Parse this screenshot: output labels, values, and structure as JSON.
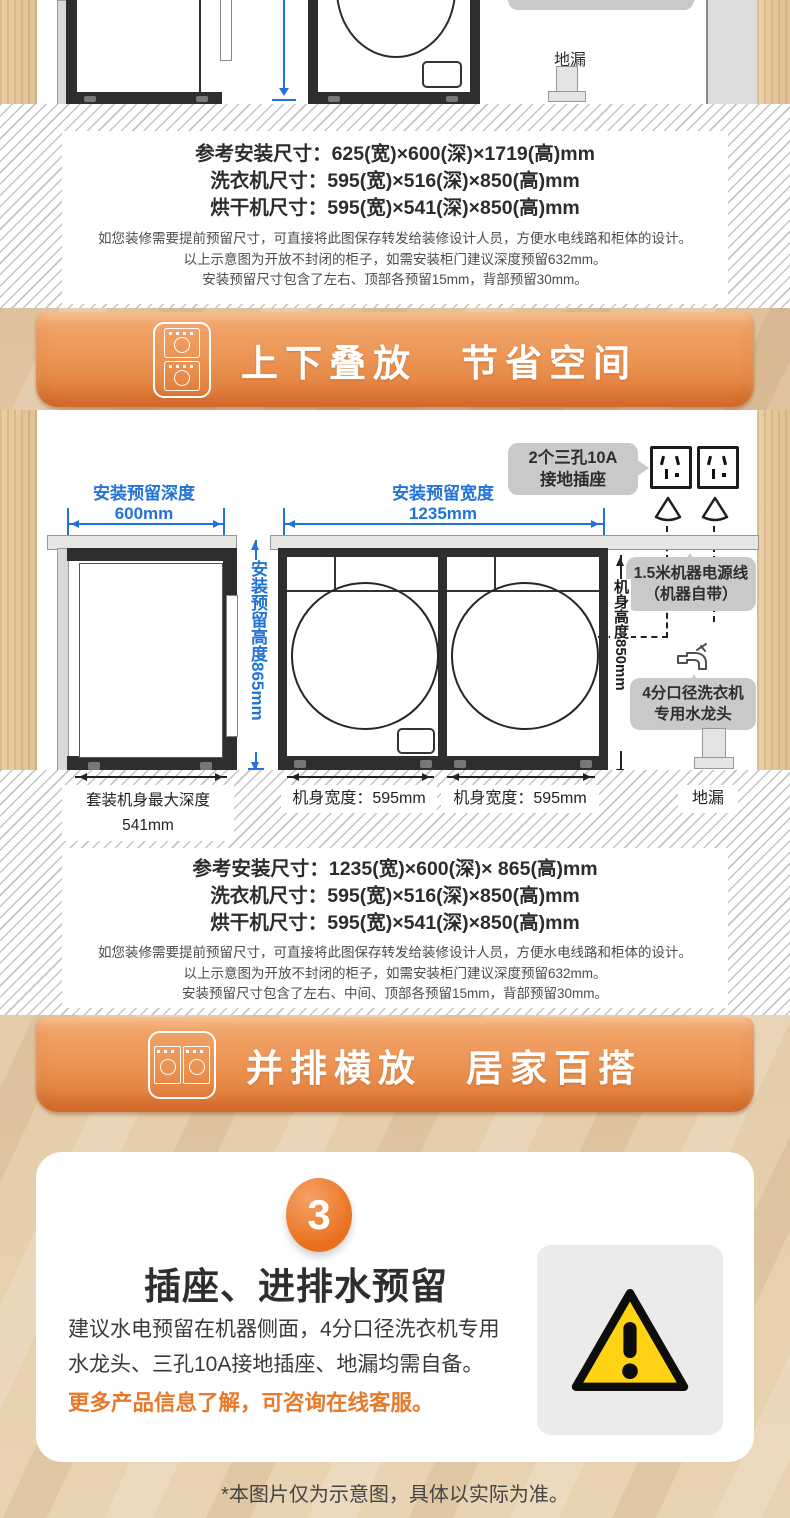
{
  "colors": {
    "accent_orange": "#E8792B",
    "dim_blue": "#2273D8",
    "banner_orange_top": "#F3A970",
    "banner_orange_bottom": "#DF7533",
    "warning_yellow": "#FFD213",
    "callout_gray": "#C9C9C9"
  },
  "top_diagram": {
    "floor_drain_label": "地漏",
    "specs": [
      "参考安装尺寸：625(宽)×600(深)×1719(高)mm",
      "洗衣机尺寸：595(宽)×516(深)×850(高)mm",
      "烘干机尺寸：595(宽)×541(深)×850(高)mm"
    ],
    "notes": [
      "如您装修需要提前预留尺寸，可直接将此图保存转发给装修设计人员，方便水电线路和柜体的设计。",
      "以上示意图为开放不封闭的柜子，如需安装柜门建议深度预留632mm。",
      "安装预留尺寸包含了左右、顶部各预留15mm，背部预留30mm。"
    ]
  },
  "stack_banner": {
    "title": "上下叠放　节省空间"
  },
  "side_diagram": {
    "depth_dim": {
      "label": "安装预留深度",
      "value": "600mm"
    },
    "width_dim": {
      "label": "安装预留宽度",
      "value": "1235mm"
    },
    "height_dim": "安装预留高度865mm",
    "body_height_dim": "机身高度850mm",
    "socket_callout": [
      "2个三孔10A",
      "接地插座"
    ],
    "power_callout": [
      "1.5米机器电源线",
      "（机器自带）"
    ],
    "faucet_callout": [
      "4分口径洗衣机",
      "专用水龙头"
    ],
    "max_depth_label": [
      "套装机身最大深度",
      "541mm"
    ],
    "body_width_left": "机身宽度：595mm",
    "body_width_right": "机身宽度：595mm",
    "floor_drain_label": "地漏",
    "specs": [
      "参考安装尺寸：1235(宽)×600(深)× 865(高)mm",
      "洗衣机尺寸：595(宽)×516(深)×850(高)mm",
      "烘干机尺寸：595(宽)×541(深)×850(高)mm"
    ],
    "notes": [
      "如您装修需要提前预留尺寸，可直接将此图保存转发给装修设计人员，方便水电线路和柜体的设计。",
      "以上示意图为开放不封闭的柜子，如需安装柜门建议深度预留632mm。",
      "安装预留尺寸包含了左右、中间、顶部各预留15mm，背部预留30mm。"
    ]
  },
  "row_banner": {
    "title": "并排横放　居家百搭"
  },
  "step_card": {
    "number": "3",
    "title": "插座、进排水预留",
    "body": "建议水电预留在机器侧面，4分口径洗衣机专用水龙头、三孔10A接地插座、地漏均需自备。",
    "cta": "更多产品信息了解，可咨询在线客服。"
  },
  "footer_note": "*本图片仅为示意图，具体以实际为准。"
}
